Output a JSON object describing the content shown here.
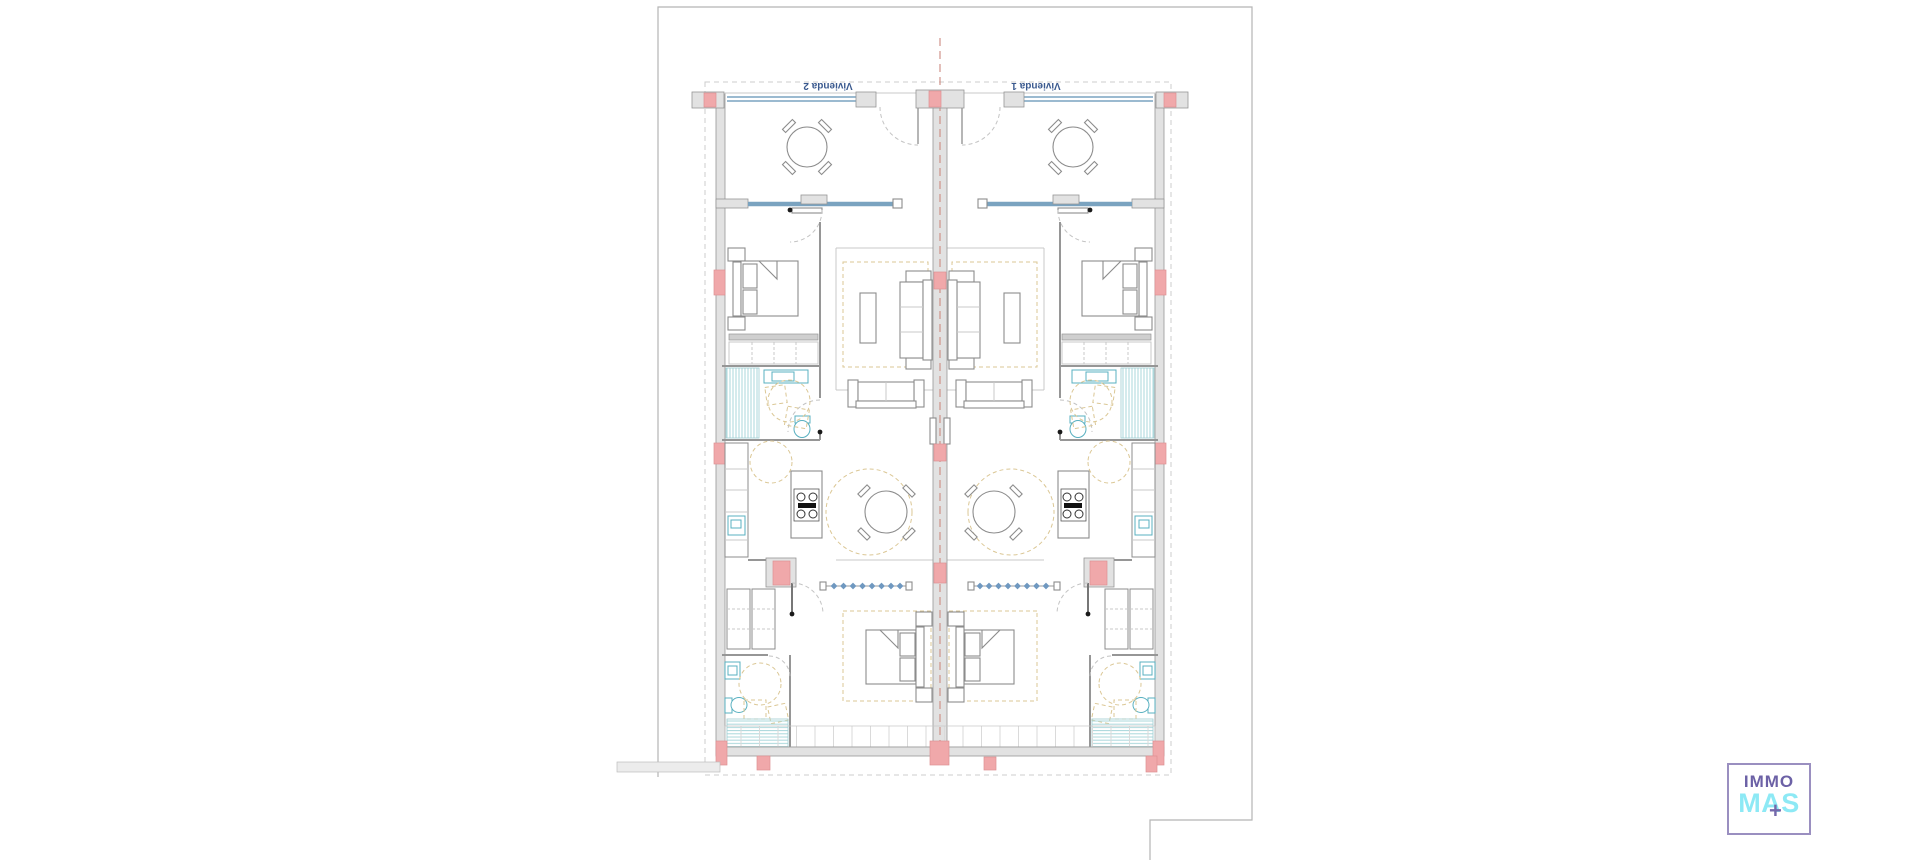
{
  "canvas": {
    "width": 1920,
    "height": 860,
    "background": "#ffffff"
  },
  "floor_plan": {
    "unit_labels": [
      {
        "id": "left",
        "text": "Vivienda 2"
      },
      {
        "id": "right",
        "text": "Vivienda 1"
      }
    ],
    "label_color": "#3b5a8f",
    "colors": {
      "wall_fill": "#e2e2e2",
      "wall_stroke": "#969696",
      "column_fill": "#f0a8aa",
      "column_stroke": "#dd9093",
      "glazing": "#7aa3c0",
      "bath_tile": "#a9d7db",
      "fixture": "#58b0c0",
      "rug": "#dbc795",
      "centerline": "#cc8a80",
      "boundary_dash": "#cccccc",
      "furniture": "#8c8c8c",
      "room_line": "#c9c9c9",
      "sheet_line": "#b5b5b5"
    }
  },
  "logo": {
    "line1": "IMMO",
    "line2": "MAS",
    "plus": "+",
    "line1_color": "#6c61a6",
    "line2_color": "#8de9f5",
    "plus_color": "#7468ab",
    "border_color": "#9a8fc0"
  }
}
